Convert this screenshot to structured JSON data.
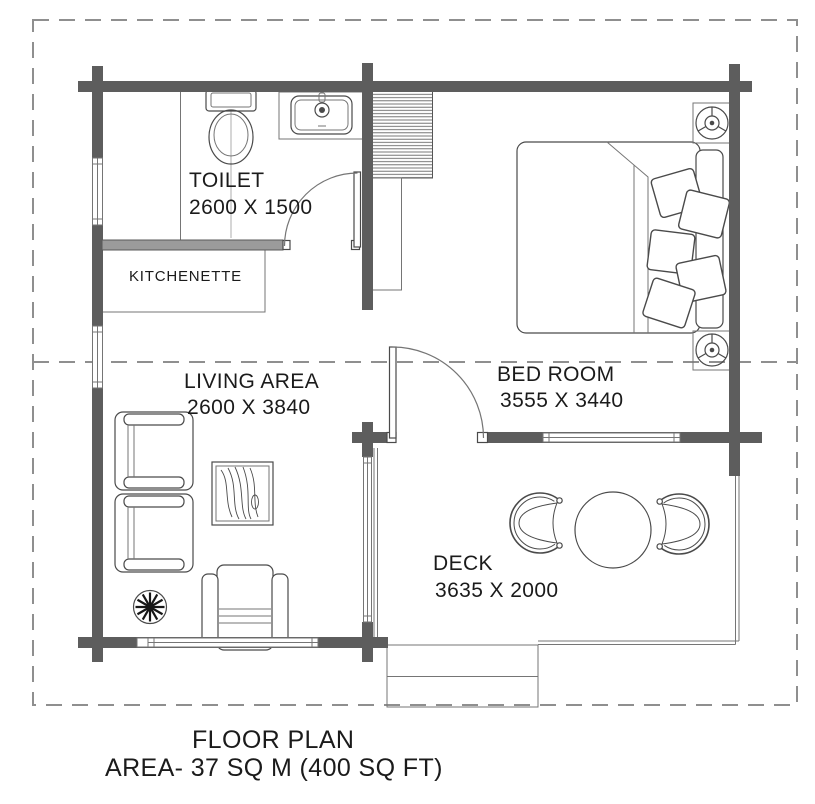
{
  "footer": {
    "title": "FLOOR PLAN",
    "area": "AREA- 37 SQ M (400 SQ FT)"
  },
  "rooms": {
    "toilet": {
      "name": "TOILET",
      "dims": "2600 X 1500"
    },
    "kitchenette": {
      "name": "KITCHENETTE"
    },
    "living_area": {
      "name": "LIVING AREA",
      "dims": "2600 X 3840"
    },
    "bedroom": {
      "name": "BED ROOM",
      "dims": "3555 X 3440"
    },
    "deck": {
      "name": "DECK",
      "dims": "3635 X 2000"
    }
  },
  "symbols": [
    "exterior-log-wall",
    "interior-partition-wall",
    "window",
    "door-swing",
    "toilet-fixture",
    "bathroom-sink",
    "kitchenette-counter",
    "wardrobe-hatched",
    "closet",
    "double-bed-with-pillows",
    "nightstand-lamp",
    "armchair",
    "coffee-table-wood-grain",
    "potted-plant",
    "deck-round-table",
    "deck-tub-chair",
    "entry-steps",
    "property-dashed-boundary",
    "roof-dashed-line"
  ],
  "colors": {
    "exterior_wall": "#5d5d5d",
    "interior_wall": "#9b9b9b",
    "line": "#4a4a4a",
    "thin_line": "#757575",
    "dash": "#8f8f8f",
    "text": "#1b1b1b",
    "background": "#ffffff"
  }
}
